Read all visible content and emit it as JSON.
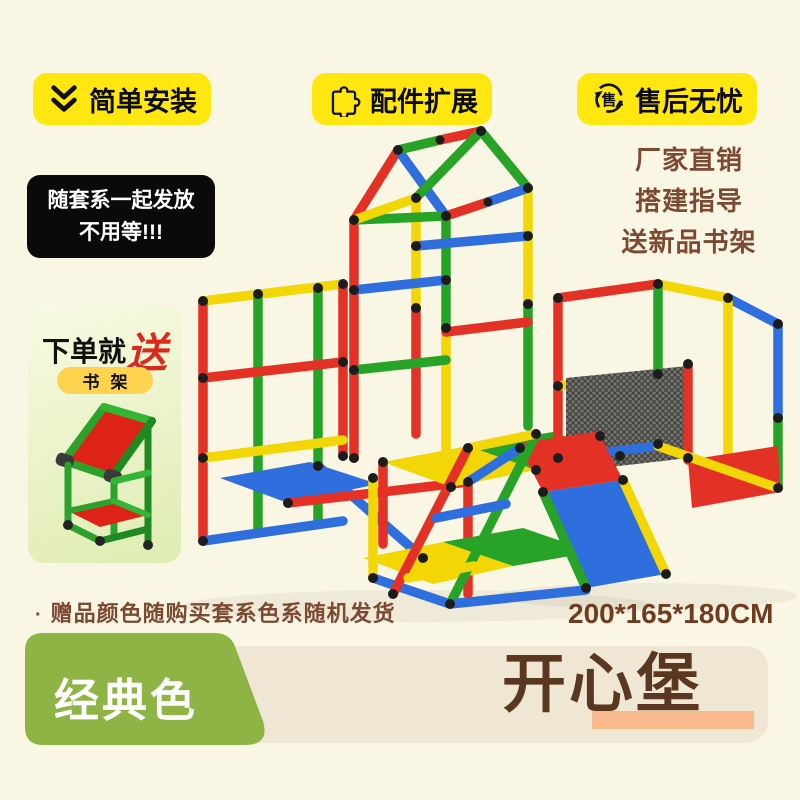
{
  "page": {
    "background": "#faf6e4"
  },
  "top_badges": [
    {
      "icon": "double-chevron-down-icon",
      "label": "简单安装"
    },
    {
      "icon": "puzzle-icon",
      "label": "配件扩展"
    },
    {
      "icon": "after-sales-cycle-icon",
      "icon_char": "售",
      "label": "售后无忧"
    }
  ],
  "shipping_note": {
    "line1": "随套系一起发放",
    "line2": "不用等!!!"
  },
  "selling_points": [
    "厂家直销",
    "搭建指导",
    "送新品书架"
  ],
  "gift_box": {
    "title_prefix": "下单就",
    "title_highlight": "送",
    "tag": "书架"
  },
  "footnote": {
    "bullet": "·",
    "text": "赠品颜色随购买套系色系随机发货"
  },
  "dimensions": "200*165*180CM",
  "banner": {
    "variant_label": "经典色",
    "product_name": "开心堡"
  },
  "colors": {
    "background": "#faf6e4",
    "badge_yellow": "#ffe70f",
    "brown_text": "#7c4a33",
    "title_brown": "#5a3721",
    "variant_green": "#8fb446",
    "band_beige": "#efe7d4",
    "underline_peach": "#f9b98c",
    "gift_red": "#d9291f",
    "tube_red": "#e43125",
    "tube_yellow": "#f2d605",
    "tube_blue": "#2f6fdd",
    "tube_green": "#27a327"
  }
}
